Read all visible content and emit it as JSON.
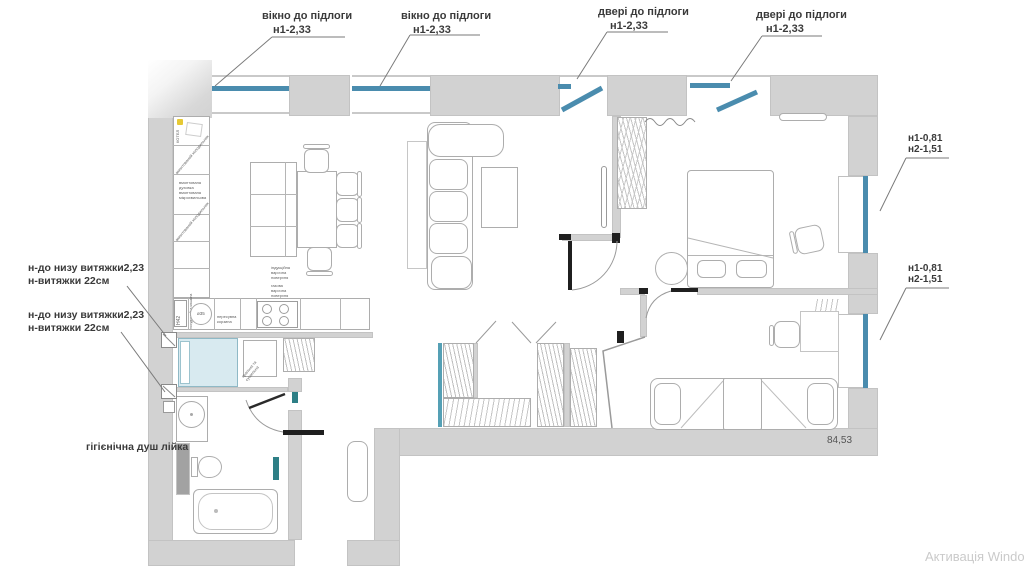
{
  "annotations": {
    "top": [
      {
        "label": "вікно до підлоги",
        "height": "н1-2,33"
      },
      {
        "label": "вікно до підлоги",
        "height": "н1-2,33"
      },
      {
        "label": "двері до підлоги",
        "height": "н1-2,33"
      },
      {
        "label": "двері до підлоги",
        "height": "н1-2,33"
      }
    ],
    "right": [
      {
        "line1": "н1-0,81",
        "line2": "н2-1,51"
      },
      {
        "line1": "н1-0,81",
        "line2": "н2-1,51"
      }
    ],
    "left": [
      {
        "line1": "н-до низу витяжки2,23",
        "line2": "н-витяжки 22см"
      },
      {
        "line1": "н-до низу витяжки2,23",
        "line2": "н-витяжки 22см"
      }
    ],
    "shower_head": "гігієнічна душ лійка",
    "area": "84,53"
  },
  "kitchen": {
    "boiler": "КОТЕЛ",
    "cell_fridge": "вмонтований холодильник",
    "cell_oven_lines": [
      "вмонтована",
      "духовка",
      "вмонтована",
      "мікрохвильова"
    ],
    "cell_fridge2": "вмонтований холодильник",
    "h42": "Н42",
    "dishwasher": "посудомийна машина",
    "sink_dia": "ø35",
    "basket_lines": [
      "пересувна",
      "корзина"
    ],
    "hob_lines": [
      "індукційна",
      "варочна",
      "поверхня",
      "газова",
      "варочна",
      "поверхня"
    ]
  },
  "bath": {
    "washer_lines": [
      "пральна та",
      "сушильна"
    ]
  },
  "watermark": "Активація Windows",
  "colors": {
    "wall": "#d2d2d2",
    "window_blue": "#4a8cae",
    "teal_accent": "#2e7f86",
    "shower_fill": "#d8eaf0"
  }
}
